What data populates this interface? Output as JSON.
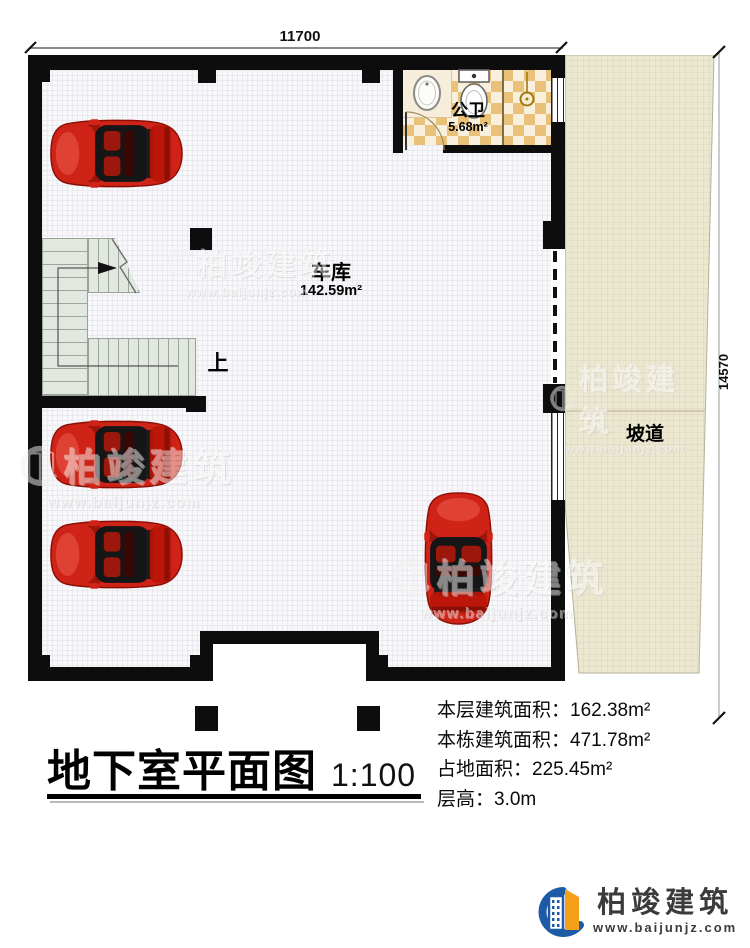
{
  "plan": {
    "dimensions": {
      "width": "11700",
      "height": "14570"
    },
    "garage": {
      "name": "车库",
      "area": "142.59m²"
    },
    "bathroom": {
      "name": "公卫",
      "area": "5.68m²"
    },
    "ramp": {
      "name": "坡道"
    },
    "stairs": {
      "up_label": "上"
    }
  },
  "footer": {
    "title": "地下室平面图",
    "scale": "1:100",
    "stats": [
      {
        "label": "本层建筑面积：",
        "value": "162.38m²"
      },
      {
        "label": "本栋建筑面积：",
        "value": "471.78m²"
      },
      {
        "label": "占地面积：",
        "value": "225.45m²"
      },
      {
        "label": "层高：",
        "value": "3.0m"
      }
    ]
  },
  "brand": {
    "name": "柏竣建筑",
    "url": "www.baijunjz.com"
  },
  "watermark": {
    "name": "柏竣建筑",
    "url": "www.baijunjz.com"
  },
  "colors": {
    "wall": "#0d0d0d",
    "brand_blue": "#1d5ba6",
    "brand_orange": "#f6a01a",
    "car_red": "#cf2317",
    "tile_tan": "#eac179",
    "ramp_beige": "#ece7d1"
  }
}
